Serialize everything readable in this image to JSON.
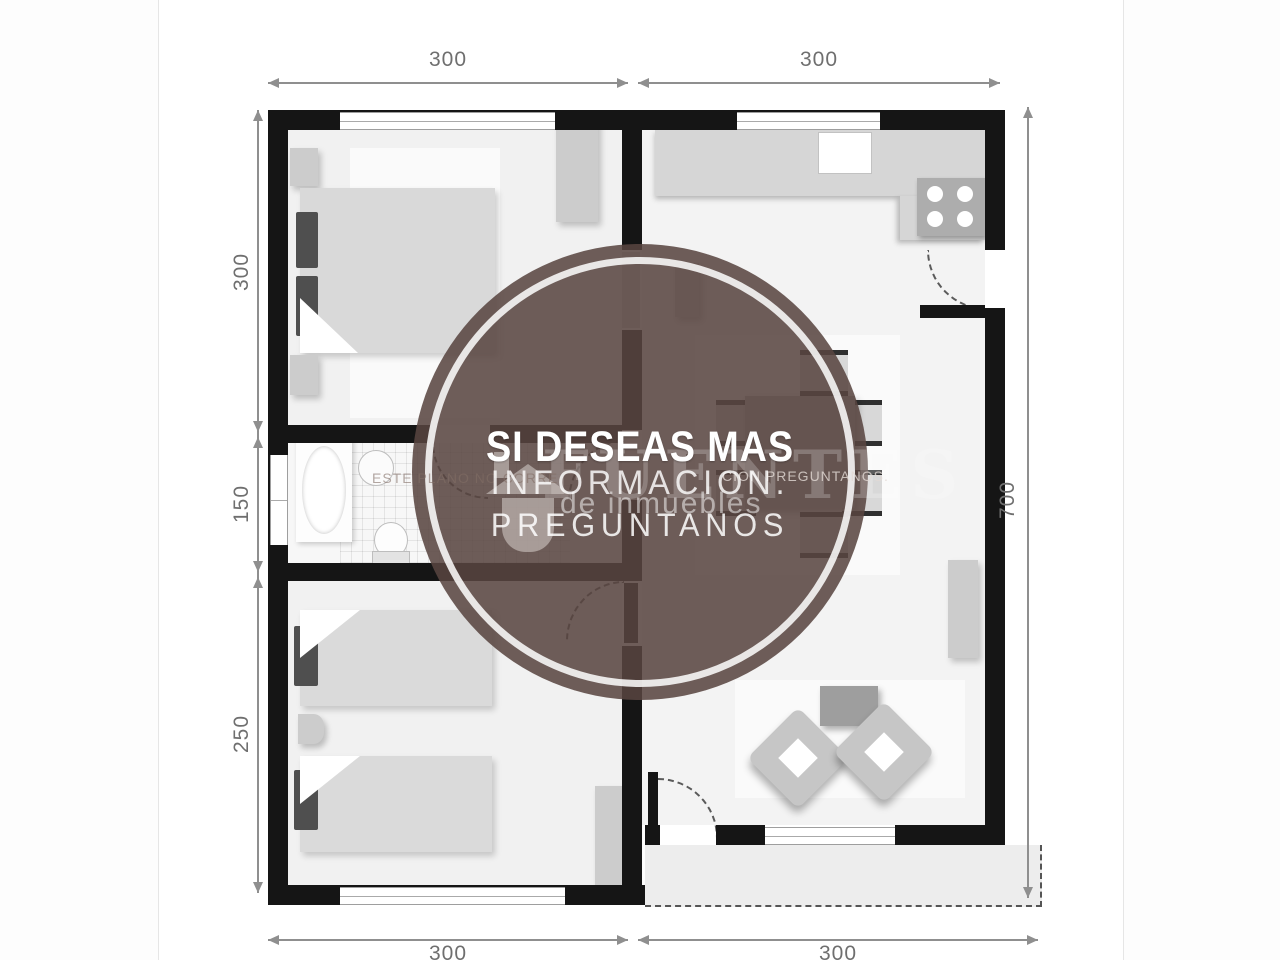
{
  "plan": {
    "type": "floor-plan-diagram",
    "colors": {
      "wall": "#151515",
      "dimension_line": "#8f8f8f",
      "floor": "#f1f1f1",
      "watermark_circle": "#584540",
      "watermark_ring": "#ffffff"
    }
  },
  "dimensions": {
    "top": [
      "300",
      "300"
    ],
    "bottom": [
      "300",
      "300"
    ],
    "left": [
      "300",
      "150",
      "250"
    ],
    "right": [
      "700"
    ]
  },
  "watermark": {
    "title": "SI DESEAS MAS",
    "line2": "INFORMACION.",
    "line3": "PREGUNTANOS",
    "brand": "FUENTES",
    "brand_tagline": "de inmuebles",
    "disclaimer_left": "ESTE PLANO NO CORRE",
    "disclaimer_right": "CION PREGUNTANOS.",
    "icon": "house-icon"
  }
}
